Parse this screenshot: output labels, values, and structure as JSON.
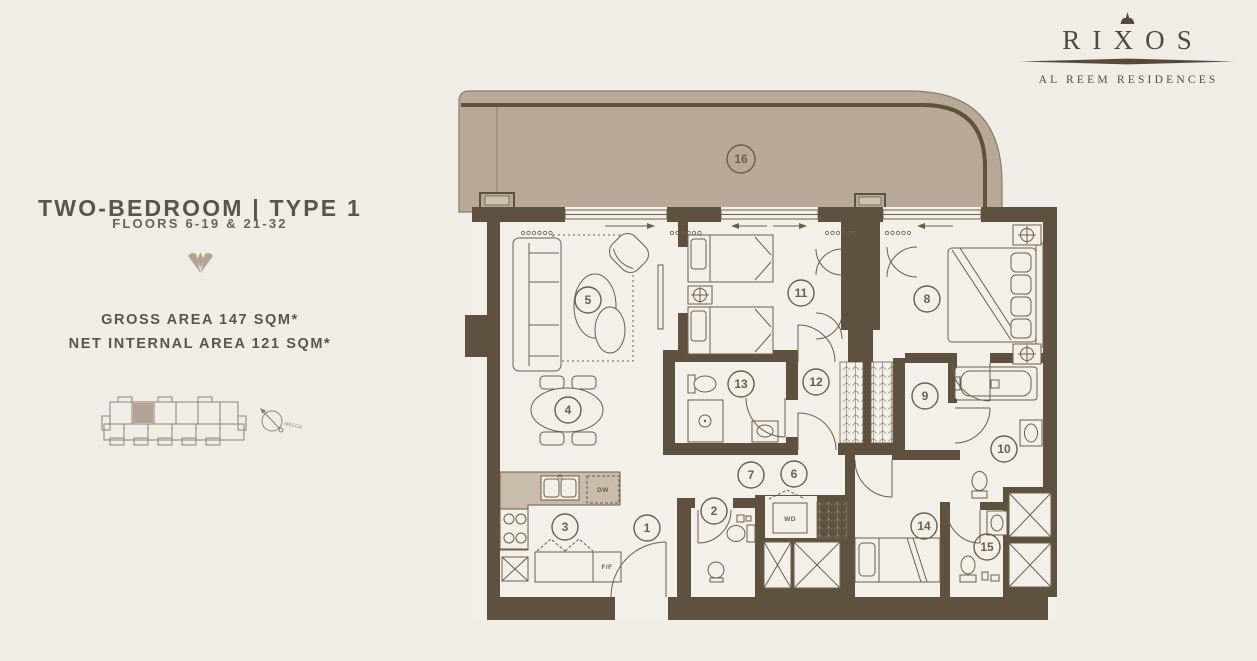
{
  "brand": {
    "name": "RIXOS",
    "tagline": "AL REEM RESIDENCES"
  },
  "panel": {
    "title": "TWO-BEDROOM | TYPE 1",
    "subtitle": "FLOORS 6-19 & 21-32",
    "gross_area": "GROSS AREA 147 SQM*",
    "net_area": "NET INTERNAL AREA 121 SQM*",
    "compass_label": "MECCA"
  },
  "floorplan": {
    "labels": {
      "dishwasher": "DW",
      "fridge_freezer": "F/F",
      "washer_dryer": "WD"
    },
    "markers": [
      {
        "number": "1",
        "x": 192,
        "y": 443
      },
      {
        "number": "2",
        "x": 259,
        "y": 426
      },
      {
        "number": "3",
        "x": 110,
        "y": 442
      },
      {
        "number": "4",
        "x": 113,
        "y": 325
      },
      {
        "number": "5",
        "x": 133,
        "y": 215
      },
      {
        "number": "6",
        "x": 339,
        "y": 389
      },
      {
        "number": "7",
        "x": 296,
        "y": 390
      },
      {
        "number": "8",
        "x": 472,
        "y": 214
      },
      {
        "number": "9",
        "x": 470,
        "y": 311
      },
      {
        "number": "10",
        "x": 549,
        "y": 364
      },
      {
        "number": "11",
        "x": 346,
        "y": 208
      },
      {
        "number": "12",
        "x": 361,
        "y": 297
      },
      {
        "number": "13",
        "x": 286,
        "y": 299
      },
      {
        "number": "14",
        "x": 469,
        "y": 441
      },
      {
        "number": "15",
        "x": 532,
        "y": 462
      },
      {
        "number": "16",
        "x": 286,
        "y": 74
      }
    ],
    "colors": {
      "wall": "#5e5140",
      "line": "#6d5e4b",
      "balcony_fill": "#b7a898",
      "counter_fill": "#c9bcab",
      "background": "#f0ede7",
      "accent_taupe": "#b2a394",
      "text": "#5b544a",
      "brand": "#57493a"
    }
  }
}
